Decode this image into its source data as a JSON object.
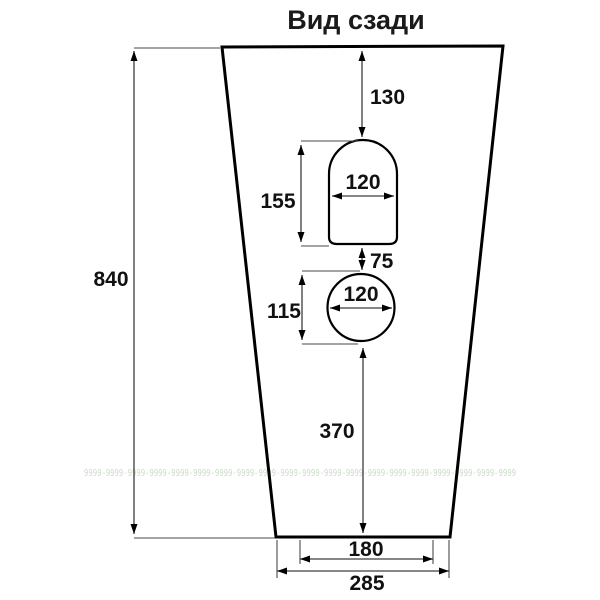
{
  "title": "Вид сзади",
  "dimensions": {
    "total_height": "840",
    "top_to_arch": "130",
    "arch_height": "155",
    "arch_width": "120",
    "arch_to_circle_gap": "75",
    "circle_height": "115",
    "circle_width": "120",
    "circle_to_bottom": "370",
    "bottom_inner_width": "180",
    "bottom_outer_width": "285"
  },
  "watermark": "9999-9999-9999-9999-9999-9999-9999-9999-9999-9999-9999-9999-9999-9999-9999-9999-9999-9999-9999-9999",
  "colors": {
    "outline": "#000000",
    "dimension_line": "#3d3d3d",
    "label": "#111111",
    "watermark": "#c3d6bf",
    "background": "#ffffff"
  }
}
